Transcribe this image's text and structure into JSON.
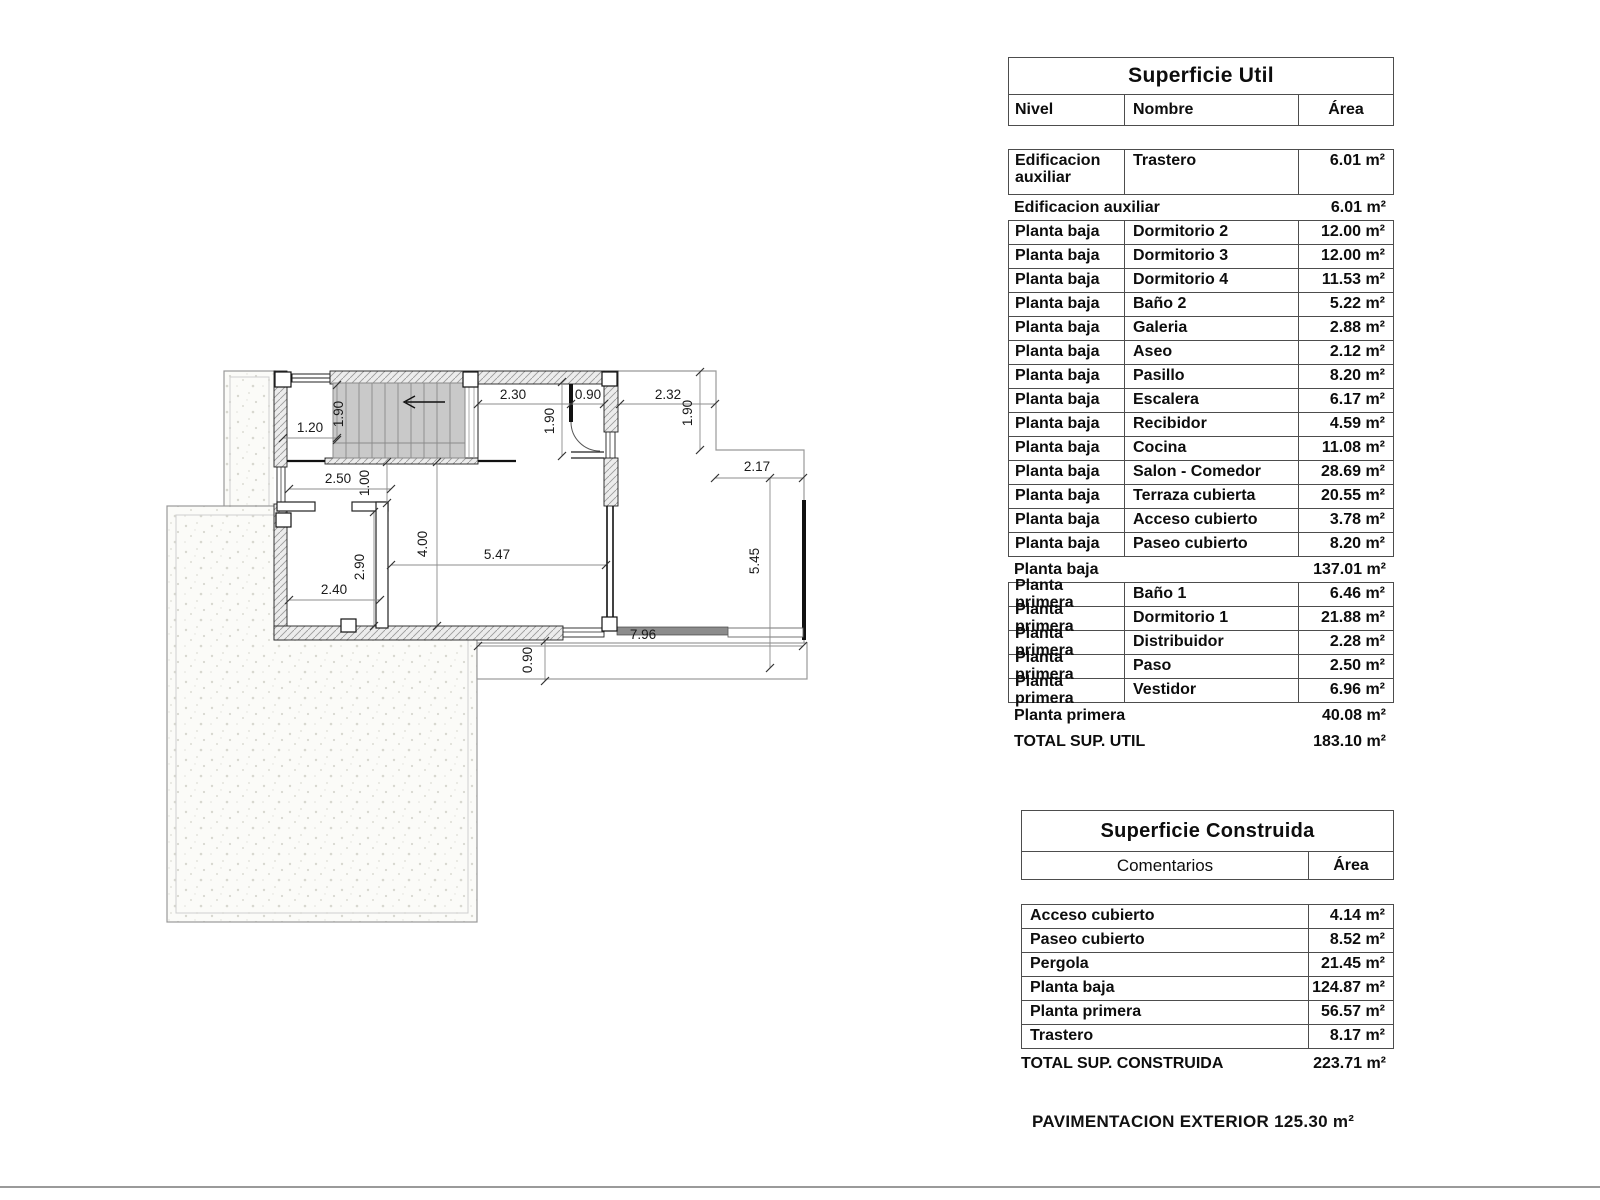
{
  "plan": {
    "dimensions": [
      "2.30",
      "0.90",
      "2.32",
      "1.90",
      "1.90",
      "1.90",
      "1.20",
      "2.50",
      "1.00",
      "4.00",
      "5.47",
      "2.90",
      "2.40",
      "2.17",
      "5.45",
      "7.96",
      "0.90"
    ]
  },
  "superficie_util": {
    "title": "Superficie Util",
    "columns": {
      "nivel": "Nivel",
      "nombre": "Nombre",
      "area": "Área"
    },
    "rows": [
      {
        "type": "data",
        "nivel": "Edificacion auxiliar",
        "nombre": "Trastero",
        "area": "6.01 m²",
        "tall": true
      },
      {
        "type": "subtotal",
        "label": "Edificacion auxiliar",
        "area": "6.01 m²"
      },
      {
        "type": "data",
        "nivel": "Planta baja",
        "nombre": "Dormitorio 2",
        "area": "12.00 m²"
      },
      {
        "type": "data",
        "nivel": "Planta baja",
        "nombre": "Dormitorio 3",
        "area": "12.00 m²"
      },
      {
        "type": "data",
        "nivel": "Planta baja",
        "nombre": "Dormitorio 4",
        "area": "11.53 m²"
      },
      {
        "type": "data",
        "nivel": "Planta baja",
        "nombre": "Baño 2",
        "area": "5.22 m²"
      },
      {
        "type": "data",
        "nivel": "Planta baja",
        "nombre": "Galeria",
        "area": "2.88 m²"
      },
      {
        "type": "data",
        "nivel": "Planta baja",
        "nombre": "Aseo",
        "area": "2.12 m²"
      },
      {
        "type": "data",
        "nivel": "Planta baja",
        "nombre": "Pasillo",
        "area": "8.20 m²"
      },
      {
        "type": "data",
        "nivel": "Planta baja",
        "nombre": "Escalera",
        "area": "6.17 m²"
      },
      {
        "type": "data",
        "nivel": "Planta baja",
        "nombre": "Recibidor",
        "area": "4.59 m²"
      },
      {
        "type": "data",
        "nivel": "Planta baja",
        "nombre": "Cocina",
        "area": "11.08 m²"
      },
      {
        "type": "data",
        "nivel": "Planta baja",
        "nombre": "Salon - Comedor",
        "area": "28.69 m²"
      },
      {
        "type": "data",
        "nivel": "Planta baja",
        "nombre": "Terraza cubierta",
        "area": "20.55 m²"
      },
      {
        "type": "data",
        "nivel": "Planta baja",
        "nombre": "Acceso cubierto",
        "area": "3.78 m²"
      },
      {
        "type": "data",
        "nivel": "Planta baja",
        "nombre": "Paseo cubierto",
        "area": "8.20 m²"
      },
      {
        "type": "subtotal",
        "label": "Planta baja",
        "area": "137.01 m²"
      },
      {
        "type": "data",
        "nivel": "Planta primera",
        "nombre": "Baño 1",
        "area": "6.46 m²"
      },
      {
        "type": "data",
        "nivel": "Planta primera",
        "nombre": "Dormitorio 1",
        "area": "21.88 m²"
      },
      {
        "type": "data",
        "nivel": "Planta primera",
        "nombre": "Distribuidor",
        "area": "2.28 m²"
      },
      {
        "type": "data",
        "nivel": "Planta primera",
        "nombre": "Paso",
        "area": "2.50 m²"
      },
      {
        "type": "data",
        "nivel": "Planta primera",
        "nombre": "Vestidor",
        "area": "6.96 m²"
      },
      {
        "type": "subtotal",
        "label": "Planta primera",
        "area": "40.08 m²"
      },
      {
        "type": "total",
        "label": "TOTAL SUP. UTIL",
        "area": "183.10 m²"
      }
    ]
  },
  "superficie_construida": {
    "title": "Superficie Construida",
    "columns": {
      "comentarios": "Comentarios",
      "area": "Área"
    },
    "rows": [
      {
        "type": "data",
        "label": "Acceso cubierto",
        "area": "4.14 m²"
      },
      {
        "type": "data",
        "label": "Paseo cubierto",
        "area": "8.52 m²"
      },
      {
        "type": "data",
        "label": "Pergola",
        "area": "21.45 m²"
      },
      {
        "type": "data",
        "label": "Planta baja",
        "area": "124.87 m²"
      },
      {
        "type": "data",
        "label": "Planta primera",
        "area": "56.57 m²"
      },
      {
        "type": "data",
        "label": "Trastero",
        "area": "8.17 m²"
      },
      {
        "type": "total",
        "label": "TOTAL SUP. CONSTRUIDA",
        "area": "223.71 m²"
      }
    ]
  },
  "footer_note": "PAVIMENTACION EXTERIOR 125.30 m²"
}
